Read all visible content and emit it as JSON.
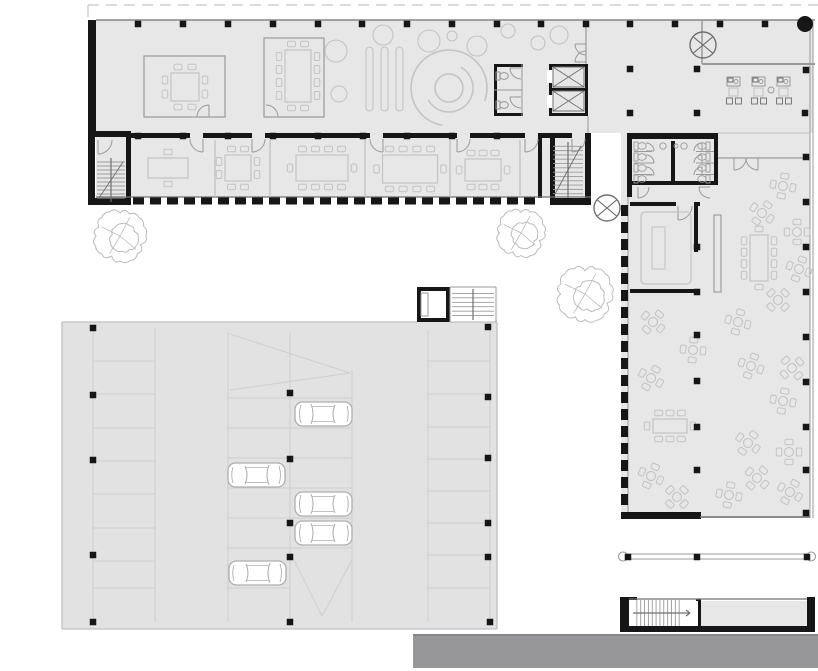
{
  "drawing_type": "architectural-floor-plan",
  "colors": {
    "bg": "#ffffff",
    "interior": "#e7e7e7",
    "parking": "#e2e2e3",
    "wall": "#161616",
    "dark": "#6f6f6f",
    "mid": "#9a9a9a",
    "light": "#c0c0c0",
    "faint": "#cfcfcf",
    "furn": "#c4c4c4",
    "road": "#97979a",
    "roadEdge": "#86868a",
    "dash": "#cfcfcf",
    "tree": "#bcbcbc",
    "white": "#ffffff",
    "carStroke": "#aeaeae"
  },
  "fills": [
    {
      "n": "main-wing-floor",
      "r": [
        96,
        20,
        492,
        177
      ],
      "c": "interior"
    },
    {
      "n": "terrace-floor",
      "r": [
        588,
        20,
        225,
        113
      ],
      "c": "interior"
    },
    {
      "n": "right-wing-floor",
      "r": [
        621,
        133,
        189,
        385
      ],
      "c": "interior"
    },
    {
      "n": "parking-deck",
      "r": [
        62,
        322,
        435,
        307
      ],
      "c": "parking"
    },
    {
      "n": "south-block-room",
      "r": [
        700,
        601,
        107,
        25
      ],
      "c": "interior"
    },
    {
      "n": "road",
      "r": [
        413,
        635,
        405,
        33
      ],
      "c": "road"
    }
  ],
  "property_line": {
    "pts": [
      88,
      5,
      818,
      5
    ],
    "stub": [
      88,
      5,
      88,
      17
    ]
  },
  "walls": [
    [
      88,
      20,
      8,
      113
    ],
    [
      88,
      131,
      42,
      6
    ],
    [
      88,
      133,
      7,
      72
    ],
    [
      88,
      198,
      42,
      7
    ],
    [
      126,
      131,
      5,
      74
    ],
    [
      131,
      133,
      59,
      5
    ],
    [
      203,
      133,
      49,
      5
    ],
    [
      265,
      133,
      105,
      5
    ],
    [
      383,
      133,
      74,
      5
    ],
    [
      470,
      133,
      55,
      5
    ],
    [
      538,
      133,
      34,
      5
    ],
    [
      585,
      133,
      5,
      5
    ],
    [
      538,
      133,
      4,
      65
    ],
    [
      550,
      133,
      5,
      65
    ],
    [
      585,
      133,
      6,
      65
    ],
    [
      550,
      198,
      41,
      7
    ],
    [
      549,
      64,
      3,
      52
    ],
    [
      585,
      64,
      3,
      52
    ],
    [
      549,
      64,
      39,
      3
    ],
    [
      549,
      113,
      39,
      3
    ],
    [
      549,
      88,
      39,
      3
    ],
    [
      494,
      64,
      29,
      3
    ],
    [
      494,
      113,
      29,
      3
    ],
    [
      494,
      64,
      3,
      52
    ],
    [
      627,
      133,
      5,
      64
    ],
    [
      630,
      133,
      88,
      6
    ],
    [
      630,
      181,
      88,
      4
    ],
    [
      714,
      139,
      4,
      46
    ],
    [
      671,
      141,
      4,
      44
    ],
    [
      630,
      202,
      46,
      4
    ],
    [
      694,
      202,
      6,
      4
    ],
    [
      694,
      202,
      4,
      50
    ],
    [
      630,
      289,
      68,
      4
    ],
    [
      621,
      512,
      80,
      7
    ],
    [
      620,
      597,
      9,
      35
    ],
    [
      807,
      597,
      8,
      35
    ],
    [
      620,
      626,
      195,
      6
    ],
    [
      696,
      599,
      5,
      28
    ],
    [
      629,
      597,
      8,
      3
    ],
    [
      417,
      287,
      33,
      4
    ],
    [
      417,
      287,
      4,
      35
    ],
    [
      446,
      287,
      4,
      35
    ],
    [
      417,
      318,
      33,
      4
    ]
  ],
  "white_notches": [
    [
      547,
      70,
      6,
      13
    ],
    [
      547,
      95,
      6,
      13
    ],
    [
      632,
      601,
      66,
      25
    ],
    [
      421,
      291,
      25,
      27
    ]
  ],
  "lines": [
    [
      96,
      20,
      815,
      20,
      "dark",
      1.2
    ],
    [
      586,
      20,
      586,
      64,
      "mid",
      1.2
    ],
    [
      588,
      116,
      588,
      133,
      "mid",
      1
    ],
    [
      702,
      20,
      702,
      64,
      "mid",
      1.5
    ],
    [
      702,
      64,
      815,
      64,
      "mid",
      2
    ],
    [
      810,
      21,
      810,
      518,
      "mid",
      1
    ],
    [
      813,
      21,
      813,
      518,
      "mid",
      1
    ],
    [
      96,
      197,
      591,
      197,
      "dark",
      1.2
    ],
    [
      718,
      158,
      808,
      158,
      "mid",
      1.2
    ],
    [
      718,
      133,
      810,
      133,
      "light",
      1
    ],
    [
      628,
      197,
      628,
      512,
      "mid",
      1
    ],
    [
      700,
      517,
      810,
      517,
      "dark",
      1.5
    ],
    [
      629,
      599,
      807,
      599,
      "dark",
      1.2
    ],
    [
      622,
      554,
      812,
      554,
      "mid",
      1
    ],
    [
      622,
      559,
      812,
      559,
      "mid",
      1
    ],
    [
      413,
      635,
      818,
      635,
      "roadEdge",
      2
    ],
    [
      522,
      64,
      522,
      116,
      "mid",
      1
    ],
    [
      494,
      90,
      522,
      90,
      "mid",
      1
    ],
    [
      62,
      322,
      417,
      322,
      "light",
      1.3
    ],
    [
      450,
      322,
      497,
      322,
      "light",
      1.3
    ],
    [
      62,
      322,
      62,
      629,
      "light",
      1.3
    ],
    [
      497,
      322,
      497,
      629,
      "light",
      1.3
    ],
    [
      62,
      629,
      497,
      629,
      "light",
      1.3
    ],
    [
      93,
      328,
      93,
      622,
      "faint",
      1
    ],
    [
      155,
      328,
      155,
      622,
      "faint",
      1
    ],
    [
      228,
      332,
      228,
      622,
      "faint",
      1
    ],
    [
      290,
      332,
      290,
      622,
      "faint",
      1
    ],
    [
      352,
      370,
      352,
      622,
      "faint",
      1
    ],
    [
      428,
      330,
      428,
      622,
      "faint",
      1
    ],
    [
      490,
      330,
      490,
      622,
      "faint",
      1
    ],
    [
      230,
      334,
      350,
      373,
      "faint",
      1
    ],
    [
      230,
      390,
      350,
      373,
      "faint",
      1
    ],
    [
      294,
      560,
      322,
      616,
      "faint",
      1
    ],
    [
      352,
      560,
      322,
      616,
      "faint",
      1
    ],
    [
      450,
      287,
      496,
      287,
      "mid",
      1
    ],
    [
      496,
      287,
      496,
      322,
      "mid",
      1
    ],
    [
      450,
      287,
      450,
      322,
      "mid",
      1
    ],
    [
      215,
      140,
      215,
      197,
      "light",
      1.3
    ],
    [
      270,
      140,
      270,
      197,
      "light",
      1.3
    ],
    [
      365,
      140,
      365,
      197,
      "light",
      1.3
    ],
    [
      450,
      140,
      450,
      197,
      "light",
      1.3
    ],
    [
      520,
      140,
      520,
      197,
      "light",
      1.3
    ]
  ],
  "facade_dashes": [
    {
      "x": 133,
      "y": 197.5,
      "len": 415,
      "o": "h",
      "on": 11,
      "off": 6,
      "t": 7
    },
    {
      "x": 621,
      "y": 205,
      "len": 306,
      "o": "v",
      "on": 11,
      "off": 6,
      "t": 7
    }
  ],
  "stall_bays": [
    {
      "x1": 93,
      "x2": 155,
      "ys": [
        361,
        394,
        428,
        461,
        494,
        528,
        561,
        588
      ]
    },
    {
      "x1": 228,
      "x2": 290,
      "ys": [
        398,
        428,
        458,
        488,
        518,
        548,
        588
      ]
    },
    {
      "x1": 290,
      "x2": 352,
      "ys": [
        398,
        428,
        458,
        488,
        518,
        548
      ]
    },
    {
      "x1": 428,
      "x2": 490,
      "ys": [
        361,
        394,
        427,
        459,
        491,
        523,
        555,
        588
      ]
    }
  ],
  "glass_rooms": [
    [
      144,
      56,
      81,
      61
    ],
    [
      264,
      38,
      60,
      79
    ]
  ],
  "doors": [
    [
      203,
      139,
      13,
      180,
      90,
      0
    ],
    [
      252,
      139,
      13,
      0,
      90,
      1
    ],
    [
      383,
      139,
      13,
      180,
      90,
      0
    ],
    [
      457,
      139,
      13,
      0,
      90,
      1
    ],
    [
      525,
      139,
      13,
      0,
      90,
      1
    ],
    [
      572,
      139,
      13,
      0,
      90,
      1
    ],
    [
      98,
      140,
      14,
      0,
      90,
      1
    ],
    [
      209,
      117,
      12,
      180,
      270,
      1
    ],
    [
      266,
      117,
      12,
      270,
      0,
      1
    ],
    [
      586,
      44,
      11,
      90,
      180,
      1
    ],
    [
      586,
      62,
      11,
      270,
      180,
      0
    ],
    [
      734,
      158,
      12,
      0,
      90,
      1
    ],
    [
      758,
      158,
      12,
      180,
      90,
      0
    ],
    [
      678,
      206,
      14,
      0,
      90,
      1
    ],
    [
      521,
      68,
      11,
      90,
      180,
      1
    ],
    [
      521,
      97,
      11,
      90,
      180,
      1
    ],
    [
      638,
      187,
      11,
      0,
      90,
      1
    ],
    [
      710,
      187,
      11,
      90,
      180,
      1
    ],
    [
      646,
      151,
      8,
      270,
      0,
      1
    ],
    [
      646,
      163,
      8,
      270,
      0,
      1
    ],
    [
      646,
      175,
      8,
      270,
      0,
      1
    ],
    [
      702,
      151,
      8,
      180,
      270,
      1
    ],
    [
      702,
      163,
      8,
      180,
      270,
      1
    ],
    [
      702,
      175,
      8,
      180,
      270,
      1
    ]
  ],
  "tables": [
    {
      "cx": 185,
      "cy": 87,
      "w": 28,
      "h": 28,
      "t": 2,
      "r": 2,
      "b": 2,
      "l": 2
    },
    {
      "cx": 298,
      "cy": 76,
      "w": 26,
      "h": 52,
      "t": 2,
      "r": 4,
      "b": 2,
      "l": 4
    },
    {
      "cx": 168,
      "cy": 168,
      "w": 40,
      "h": 20,
      "t": 1,
      "r": 0,
      "b": 1,
      "l": 0
    },
    {
      "cx": 238,
      "cy": 168,
      "w": 26,
      "h": 26,
      "t": 2,
      "r": 2,
      "b": 2,
      "l": 2
    },
    {
      "cx": 322,
      "cy": 168,
      "w": 52,
      "h": 26,
      "t": 4,
      "r": 1,
      "b": 4,
      "l": 1
    },
    {
      "cx": 410,
      "cy": 169,
      "w": 55,
      "h": 28,
      "t": 4,
      "r": 1,
      "b": 4,
      "l": 1
    },
    {
      "cx": 483,
      "cy": 170,
      "w": 36,
      "h": 22,
      "t": 3,
      "r": 1,
      "b": 3,
      "l": 1
    },
    {
      "cx": 759,
      "cy": 258,
      "w": 18,
      "h": 46,
      "t": 1,
      "r": 4,
      "b": 1,
      "l": 4
    },
    {
      "cx": 670,
      "cy": 426,
      "w": 34,
      "h": 14,
      "t": 3,
      "r": 1,
      "b": 3,
      "l": 1
    }
  ],
  "flower_tables": [
    [
      783,
      186,
      10
    ],
    [
      762,
      213,
      35
    ],
    [
      797,
      232,
      0
    ],
    [
      799,
      269,
      20
    ],
    [
      778,
      300,
      45
    ],
    [
      738,
      322,
      15
    ],
    [
      653,
      322,
      40
    ],
    [
      693,
      350,
      5
    ],
    [
      651,
      378,
      30
    ],
    [
      751,
      366,
      20
    ],
    [
      792,
      368,
      50
    ],
    [
      783,
      401,
      10
    ],
    [
      748,
      443,
      35
    ],
    [
      789,
      452,
      0
    ],
    [
      651,
      476,
      25
    ],
    [
      677,
      497,
      45
    ],
    [
      729,
      495,
      10
    ],
    [
      790,
      492,
      30
    ],
    [
      757,
      478,
      40
    ]
  ],
  "plant_circles": [
    [
      336,
      51,
      11
    ],
    [
      339,
      94,
      8
    ],
    [
      383,
      35,
      10
    ],
    [
      429,
      41,
      11
    ],
    [
      452,
      36,
      5
    ],
    [
      477,
      46,
      10
    ],
    [
      508,
      31,
      7
    ],
    [
      538,
      43,
      7
    ],
    [
      559,
      35,
      9
    ]
  ],
  "pills": [
    [
      366,
      47,
      7,
      64
    ],
    [
      381,
      47,
      7,
      64
    ],
    [
      396,
      47,
      7,
      64
    ]
  ],
  "spiral": {
    "c": [
      449,
      88
    ],
    "r0": 14,
    "arcs": [
      [
        24,
        -60,
        150
      ],
      [
        38,
        100,
        20
      ]
    ]
  },
  "trees": [
    [
      120,
      236,
      26
    ],
    [
      521,
      233,
      24
    ],
    [
      585,
      294,
      28
    ]
  ],
  "cars": [
    [
      295,
      402,
      0
    ],
    [
      228,
      463,
      1
    ],
    [
      295,
      492,
      0
    ],
    [
      295,
      521,
      0
    ],
    [
      229,
      561,
      1
    ]
  ],
  "columns": [
    [
      138,
      24
    ],
    [
      183,
      24
    ],
    [
      228,
      24
    ],
    [
      273,
      24
    ],
    [
      318,
      24
    ],
    [
      362,
      24
    ],
    [
      407,
      24
    ],
    [
      452,
      24
    ],
    [
      497,
      24
    ],
    [
      541,
      24
    ],
    [
      586,
      24
    ],
    [
      630,
      24
    ],
    [
      675,
      24
    ],
    [
      720,
      24
    ],
    [
      765,
      24
    ],
    [
      138,
      136
    ],
    [
      183,
      136
    ],
    [
      228,
      136
    ],
    [
      273,
      136
    ],
    [
      318,
      136
    ],
    [
      363,
      136
    ],
    [
      407,
      136
    ],
    [
      452,
      136
    ],
    [
      497,
      136
    ],
    [
      630,
      69
    ],
    [
      697,
      69
    ],
    [
      806,
      70
    ],
    [
      630,
      113
    ],
    [
      697,
      113
    ],
    [
      805,
      113
    ],
    [
      806,
      157
    ],
    [
      806,
      202
    ],
    [
      806,
      247
    ],
    [
      806,
      292
    ],
    [
      806,
      337
    ],
    [
      806,
      382
    ],
    [
      806,
      427
    ],
    [
      806,
      470
    ],
    [
      806,
      513
    ],
    [
      697,
      247
    ],
    [
      697,
      292
    ],
    [
      697,
      335
    ],
    [
      697,
      381
    ],
    [
      697,
      427
    ],
    [
      697,
      470
    ],
    [
      93,
      328
    ],
    [
      93,
      395
    ],
    [
      93,
      460
    ],
    [
      93,
      555
    ],
    [
      93,
      622
    ],
    [
      290,
      393
    ],
    [
      290,
      459
    ],
    [
      290,
      523
    ],
    [
      290,
      557
    ],
    [
      290,
      622
    ],
    [
      488,
      327
    ],
    [
      488,
      397
    ],
    [
      488,
      458
    ],
    [
      488,
      523
    ],
    [
      488,
      557
    ],
    [
      490,
      622
    ],
    [
      628,
      557
    ],
    [
      697,
      557
    ],
    [
      807,
      557
    ]
  ],
  "circle_cross": [
    [
      703,
      45,
      13
    ],
    [
      607,
      208,
      13
    ]
  ],
  "dot_circle": [
    805,
    24,
    8
  ],
  "terrace_sets": [
    [
      734,
      91
    ],
    [
      759,
      91
    ],
    [
      784,
      91
    ]
  ],
  "small_circle": [
    771,
    90,
    3
  ],
  "pergola_ends": [
    [
      623,
      556.5
    ],
    [
      811,
      556.5
    ]
  ],
  "elevator_cells": [
    [
      553,
      67,
      31,
      20
    ],
    [
      553,
      91,
      31,
      20
    ]
  ],
  "wc_small_toilets": [
    [
      502,
      76
    ],
    [
      502,
      105
    ]
  ],
  "wc_large": {
    "cx_left": 640,
    "cx_right": 704,
    "rows": [
      146,
      157,
      168,
      179
    ],
    "div_left": [
      634,
      652
    ],
    "div_right": [
      696,
      714
    ],
    "div_ys": [
      151.5,
      163,
      174.5
    ],
    "sinks": [
      [
        663,
        146,
        3.2
      ],
      [
        684,
        146,
        3.2
      ],
      [
        676,
        146,
        2
      ]
    ]
  },
  "meeting_furniture": {
    "outer": [
      641,
      212,
      50,
      72
    ],
    "inner": [
      652,
      227,
      13,
      42
    ]
  },
  "counter": [
    714,
    215,
    7,
    77
  ],
  "tower_cell": [
    421,
    293,
    7,
    23
  ],
  "stairs": [
    {
      "x": 97,
      "y": 158,
      "w": 28,
      "h": 44,
      "n": 10,
      "o": "h",
      "rail": "v",
      "diag": 1
    },
    {
      "x": 553,
      "y": 142,
      "w": 30,
      "h": 56,
      "n": 12,
      "o": "h",
      "rail": "v",
      "diag": 1
    },
    {
      "x": 452,
      "y": 289,
      "w": 42,
      "h": 31,
      "n": 6,
      "o": "h",
      "rail": "v",
      "diag": 0
    },
    {
      "x": 633,
      "y": 600,
      "w": 50,
      "h": 26,
      "n": 12,
      "o": "v",
      "rail": "h",
      "diag": 0
    }
  ]
}
